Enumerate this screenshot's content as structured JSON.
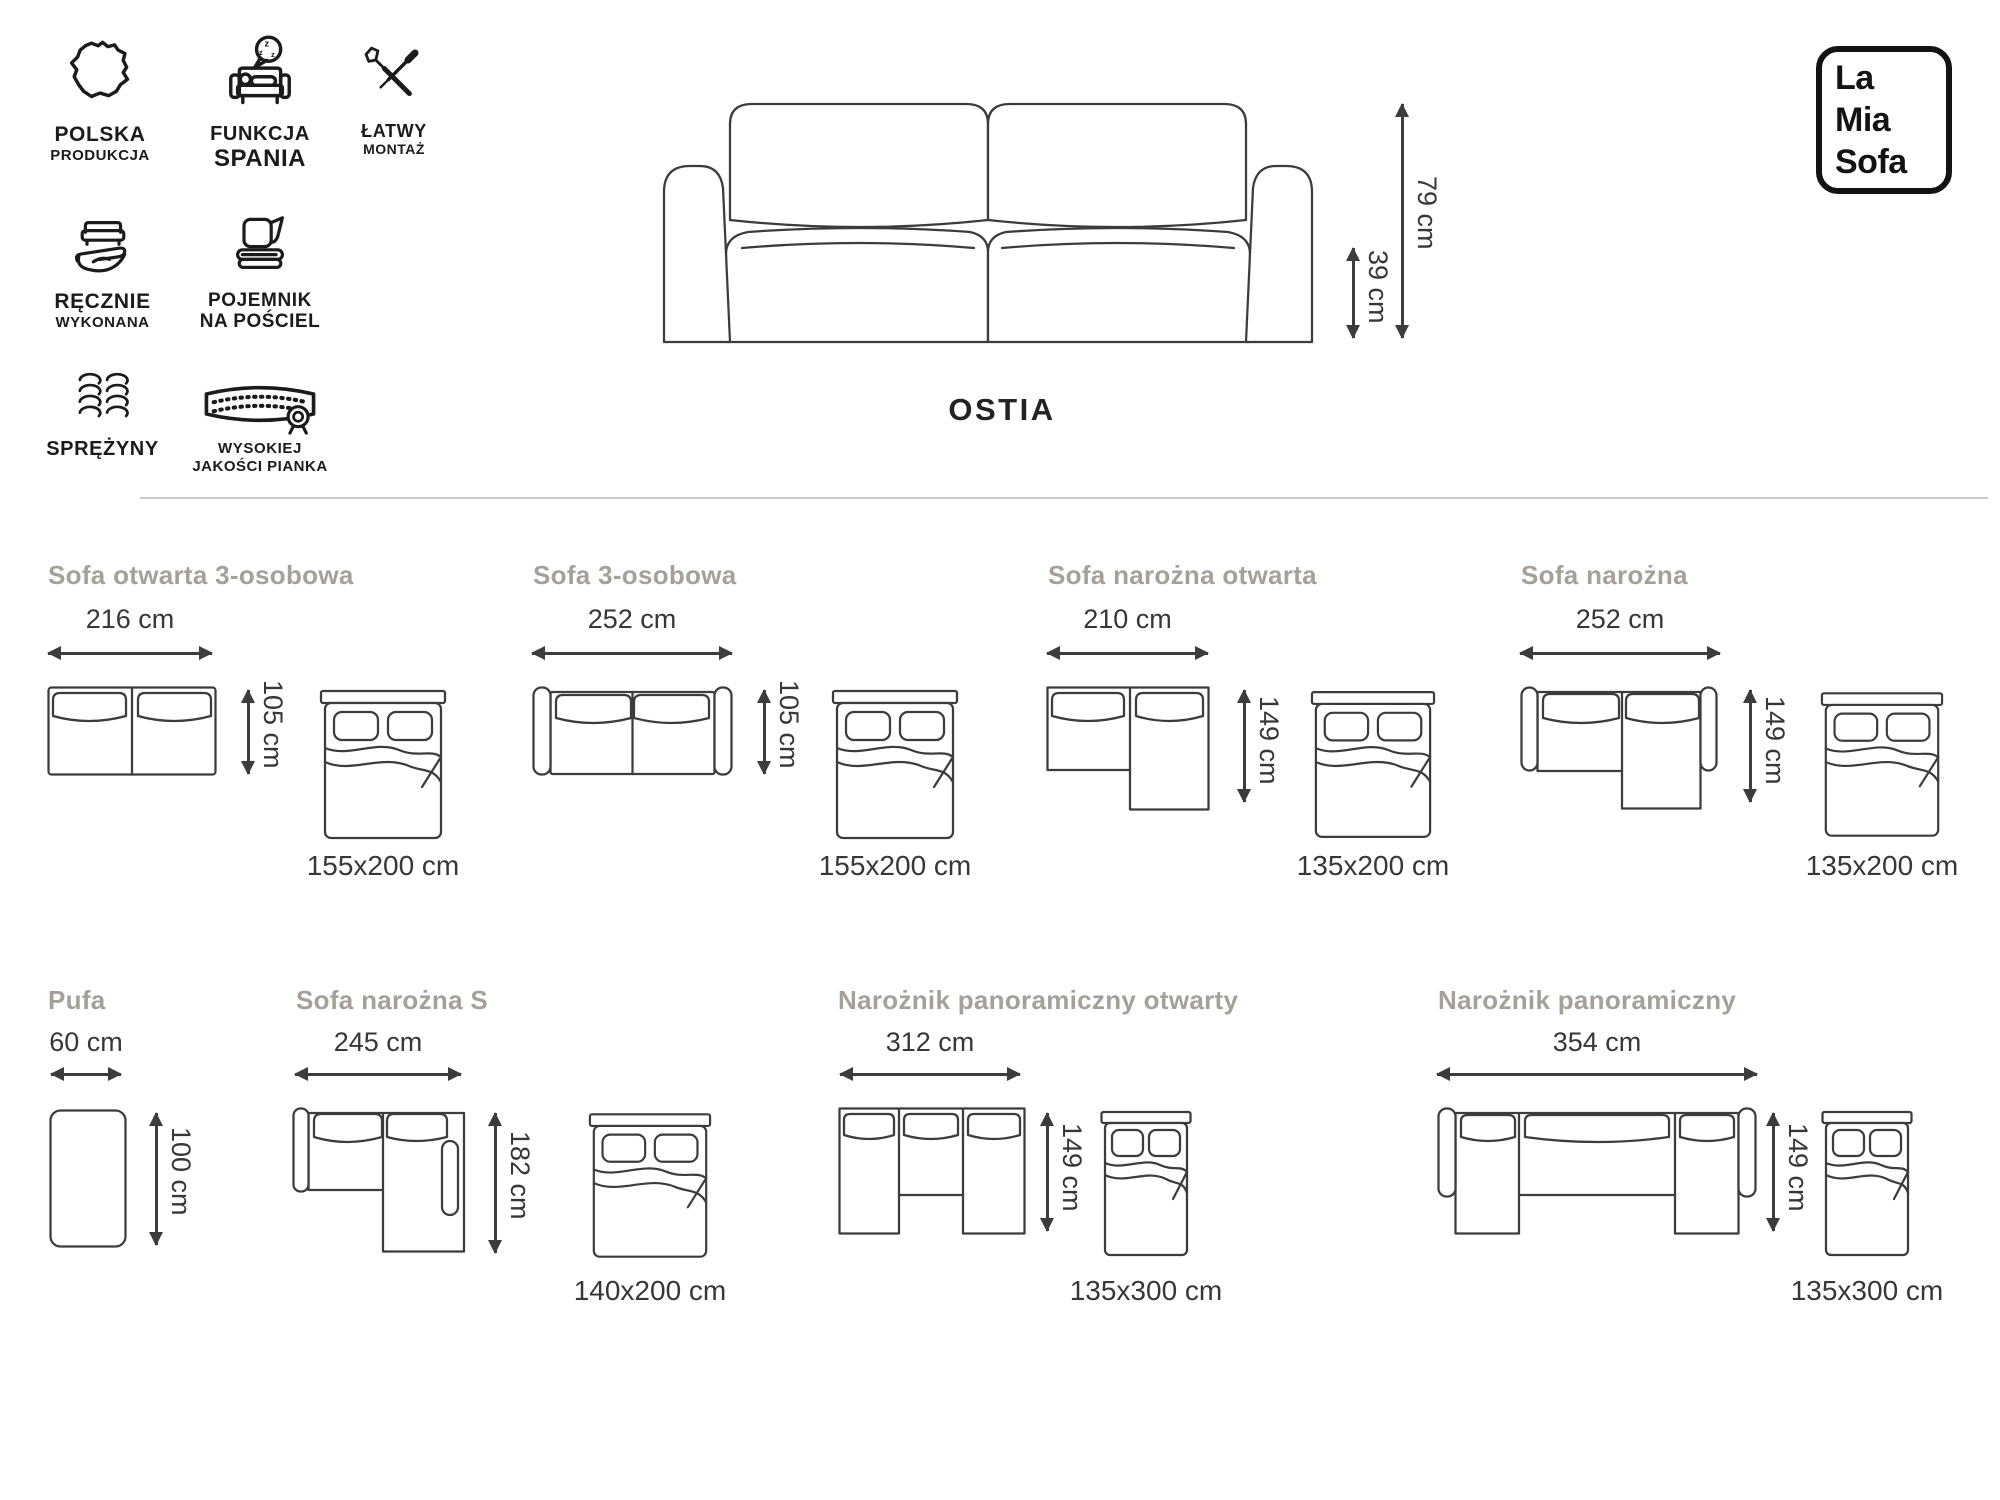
{
  "colors": {
    "line": "#3c3c3c",
    "icon": "#1b1b1b",
    "title_gray": "#a5a19a",
    "text_dark": "#373737",
    "divider": "#cacaca"
  },
  "header": {
    "features": [
      {
        "id": "polska-produkcja",
        "line1": "POLSKA",
        "line2": "PRODUKCJA"
      },
      {
        "id": "funkcja-spania",
        "line1": "FUNKCJA",
        "line2": "SPANIA",
        "bubble": [
          "z",
          "z",
          "z"
        ]
      },
      {
        "id": "latwy-montaz",
        "line1": "ŁATWY",
        "line2": "MONTAŻ"
      },
      {
        "id": "recznie-wykonana",
        "line1": "RĘCZNIE",
        "line2": "WYKONANA"
      },
      {
        "id": "pojemnik-na-posciel",
        "line1": "POJEMNIK",
        "line2": "NA POŚCIEL"
      },
      {
        "id": "sprezyny",
        "line1": "SPRĘŻYNY",
        "line2": ""
      },
      {
        "id": "wysokiej-jakosci-pianka",
        "line1": "WYSOKIEJ",
        "line2": "JAKOŚCI PIANKA"
      }
    ],
    "product_name": "OSTIA",
    "dims": {
      "height": "79 cm",
      "seat_height": "39 cm"
    },
    "logo": [
      "La",
      "Mia",
      "Sofa"
    ]
  },
  "variants": {
    "row1": [
      {
        "title": "Sofa otwarta 3-osobowa",
        "width": "216 cm",
        "depth": "105 cm",
        "bed": "155x200 cm"
      },
      {
        "title": "Sofa 3-osobowa",
        "width": "252 cm",
        "depth": "105 cm",
        "bed": "155x200 cm"
      },
      {
        "title": "Sofa narożna otwarta",
        "width": "210 cm",
        "depth": "149 cm",
        "bed": "135x200 cm"
      },
      {
        "title": "Sofa narożna",
        "width": "252 cm",
        "depth": "149 cm",
        "bed": "135x200 cm"
      }
    ],
    "row2": [
      {
        "title": "Pufa",
        "width": "60 cm",
        "depth": "100 cm"
      },
      {
        "title": "Sofa narożna S",
        "width": "245 cm",
        "depth": "182 cm",
        "bed": "140x200 cm"
      },
      {
        "title": "Narożnik panoramiczny otwarty",
        "width": "312 cm",
        "depth": "149 cm",
        "bed": "135x300 cm"
      },
      {
        "title": "Narożnik panoramiczny",
        "width": "354 cm",
        "depth": "149 cm",
        "bed": "135x300 cm"
      }
    ]
  }
}
